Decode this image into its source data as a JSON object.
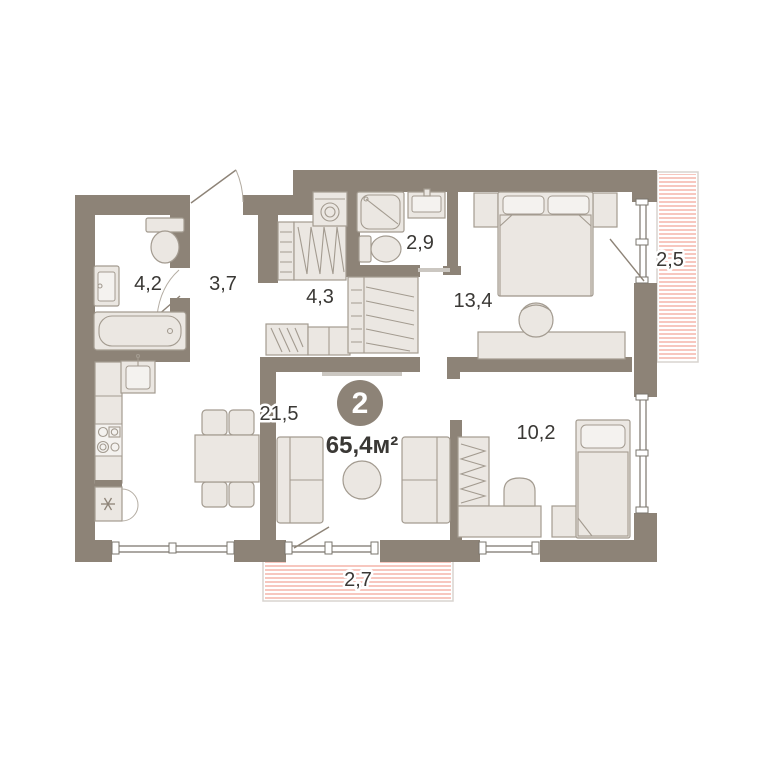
{
  "floor_plan": {
    "badge": {
      "room_count": "2",
      "total_area": "65,4м²"
    },
    "rooms": [
      {
        "name": "bathroom",
        "area": "4,2"
      },
      {
        "name": "hallway",
        "area": "3,7"
      },
      {
        "name": "wardrobe-room",
        "area": "4,3"
      },
      {
        "name": "shower-room",
        "area": "2,9"
      },
      {
        "name": "bedroom-main",
        "area": "13,4"
      },
      {
        "name": "balcony-right",
        "area": "2,5"
      },
      {
        "name": "living-kitchen",
        "area": "21,5"
      },
      {
        "name": "bedroom-second",
        "area": "10,2"
      },
      {
        "name": "balcony-bottom",
        "area": "2,7"
      }
    ],
    "icons": {
      "fridge": "snowflake-icon"
    },
    "colors": {
      "wall": "#8d8377",
      "furniture_fill": "#ebe7e2",
      "furniture_stroke": "#a39b90",
      "balcony_hatch": "#f0998a",
      "balcony_border": "#d8d4cf",
      "label_text": "#3a3835",
      "badge_fill": "#8d8377",
      "badge_text": "#ffffff",
      "background": "#ffffff"
    }
  }
}
